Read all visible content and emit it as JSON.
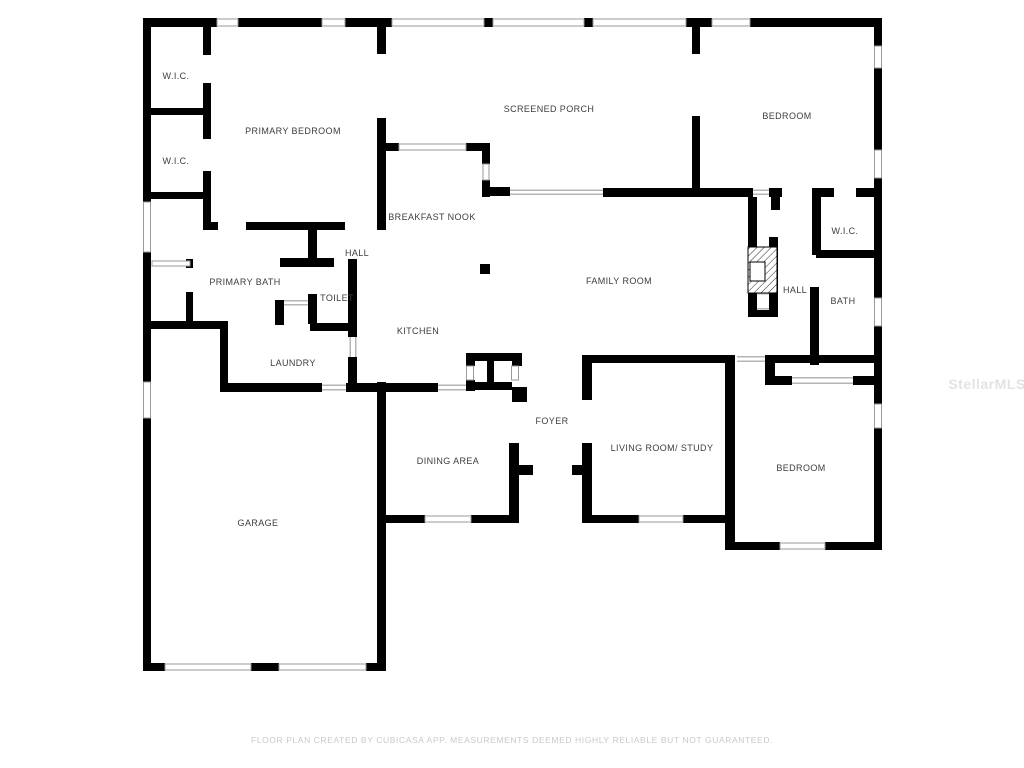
{
  "floor_plan": {
    "rooms": [
      {
        "id": "wic-upper",
        "label": "W.I.C."
      },
      {
        "id": "wic-lower",
        "label": "W.I.C."
      },
      {
        "id": "primary-bedroom",
        "label": "PRIMARY BEDROOM"
      },
      {
        "id": "screened-porch",
        "label": "SCREENED PORCH"
      },
      {
        "id": "bedroom-top-right",
        "label": "BEDROOM"
      },
      {
        "id": "breakfast-nook",
        "label": "BREAKFAST NOOK"
      },
      {
        "id": "hall-upper",
        "label": "HALL"
      },
      {
        "id": "primary-bath",
        "label": "PRIMARY BATH"
      },
      {
        "id": "toilet",
        "label": "TOILET"
      },
      {
        "id": "family-room",
        "label": "FAMILY ROOM"
      },
      {
        "id": "hall-right",
        "label": "HALL"
      },
      {
        "id": "wic-right",
        "label": "W.I.C."
      },
      {
        "id": "bath-right",
        "label": "BATH"
      },
      {
        "id": "kitchen",
        "label": "KITCHEN"
      },
      {
        "id": "laundry",
        "label": "LAUNDRY"
      },
      {
        "id": "garage",
        "label": "GARAGE"
      },
      {
        "id": "dining-area",
        "label": "DINING AREA"
      },
      {
        "id": "foyer",
        "label": "FOYER"
      },
      {
        "id": "living-room-study",
        "label": "LIVING ROOM/ STUDY"
      },
      {
        "id": "bedroom-bottom-right",
        "label": "BEDROOM"
      }
    ]
  },
  "watermark": {
    "text": "StellarMLS"
  },
  "footer": {
    "text": "FLOOR PLAN CREATED BY CUBICASA APP. MEASUREMENTS DEEMED HIGHLY RELIABLE BUT NOT GUARANTEED."
  },
  "colors": {
    "wall": "#000000",
    "label_text": "#3d3d3d",
    "window_stroke": "#9a9a9a",
    "opening_line": "#b5b5b5",
    "footer_text": "#c9c9c9",
    "watermark_text": "#e3e3e3"
  }
}
